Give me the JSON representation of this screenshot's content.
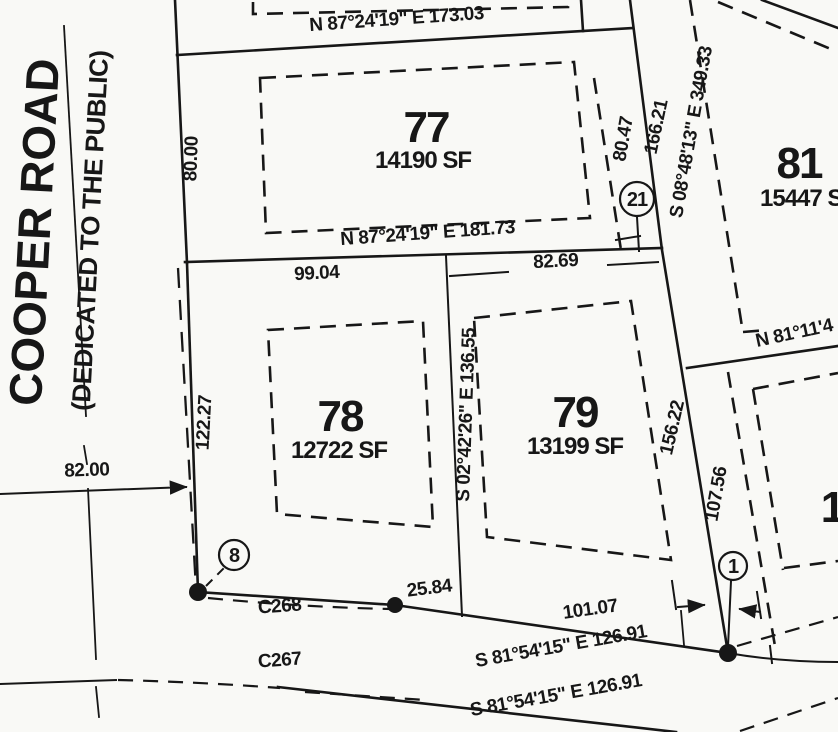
{
  "map": {
    "road": {
      "name": "COOPER ROAD",
      "dedication": "(DEDICATED TO THE PUBLIC)"
    },
    "lots": {
      "lot77": {
        "number": "77",
        "area": "14190 SF"
      },
      "lot78": {
        "number": "78",
        "area": "12722 SF"
      },
      "lot79": {
        "number": "79",
        "area": "13199 SF"
      },
      "lot81": {
        "number": "81",
        "area": "15447 SF"
      },
      "lot_se_partial": {
        "number": "1"
      }
    },
    "bearings": {
      "top": "N 87°24'19\" E 173.03",
      "lot77_south": "N 87°24'19\" E 181.73",
      "east": "S 08°48'13\" E 349.33",
      "mid": "S 02°42'26\" E 136.55",
      "lot81_south": "N 81°11'4",
      "south_upper": "S 81°54'15\" E 126.91",
      "south_lower": "S 81°54'15\" E 126.91"
    },
    "dimensions": {
      "d80_00": "80.00",
      "d80_47": "80.47",
      "d166_21": "166.21",
      "d99_04": "99.04",
      "d82_69": "82.69",
      "d122_27": "122.27",
      "d156_22": "156.22",
      "d107_56": "107.56",
      "d82_00": "82.00",
      "d25_84": "25.84",
      "d101_07": "101.07"
    },
    "curves": {
      "c268": "C268",
      "c267": "C267"
    },
    "markers": {
      "m8": "8",
      "m21": "21",
      "m1": "1"
    },
    "colors": {
      "ink": "#171717",
      "paper": "#f9f9f6"
    }
  }
}
